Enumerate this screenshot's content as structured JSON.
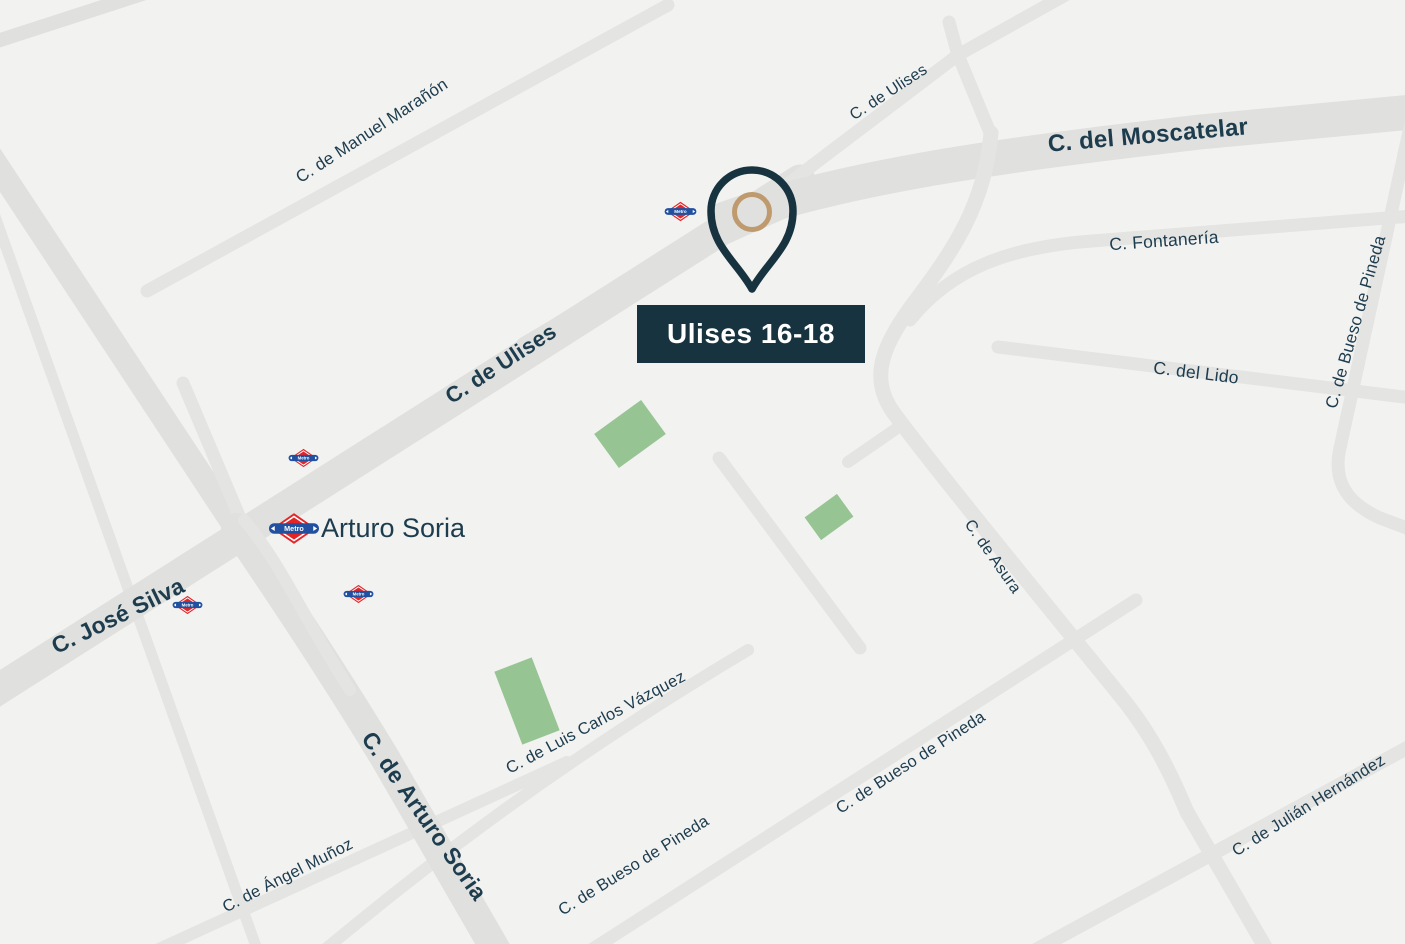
{
  "map": {
    "colors": {
      "background": "#f2f2f1",
      "road_major": "#e0e0de",
      "road_minor": "#e4e4e2",
      "park": "#97c493",
      "street_text": "#1d3c4e",
      "marker_dark": "#17333f",
      "pin_ring": "#bf9a6e",
      "metro_red": "#e32528",
      "metro_blue": "#2150a0"
    },
    "marker": {
      "label": "Ulises 16-18"
    },
    "station": {
      "name": "Arturo Soria"
    },
    "metro": {
      "logo_text": "Metro"
    },
    "streets": [
      {
        "id": "manuel-maranon",
        "name": "C. de Manuel Marañón"
      },
      {
        "id": "ulises-top",
        "name": "C. de Ulises"
      },
      {
        "id": "moscatelar",
        "name": "C. del Moscatelar"
      },
      {
        "id": "fontaneria",
        "name": "C. Fontanería"
      },
      {
        "id": "lido",
        "name": "C. del Lido"
      },
      {
        "id": "bueso-pineda-right",
        "name": "C. de Bueso de Pineda"
      },
      {
        "id": "ulises-mid",
        "name": "C. de Ulises"
      },
      {
        "id": "asura",
        "name": "C. de Asura"
      },
      {
        "id": "jose-silva",
        "name": "C. José Silva"
      },
      {
        "id": "arturo-soria-road",
        "name": "C. de Arturo Soria"
      },
      {
        "id": "angel-munoz",
        "name": "C. de Ángel Muñoz"
      },
      {
        "id": "luis-carlos-vazquez",
        "name": "C. de Luis Carlos Vázquez"
      },
      {
        "id": "bueso-pineda-bl",
        "name": "C. de Bueso de Pineda"
      },
      {
        "id": "bueso-pineda-mid",
        "name": "C. de Bueso de Pineda"
      },
      {
        "id": "julian-hernandez",
        "name": "C. de Julián Hernández"
      }
    ]
  }
}
